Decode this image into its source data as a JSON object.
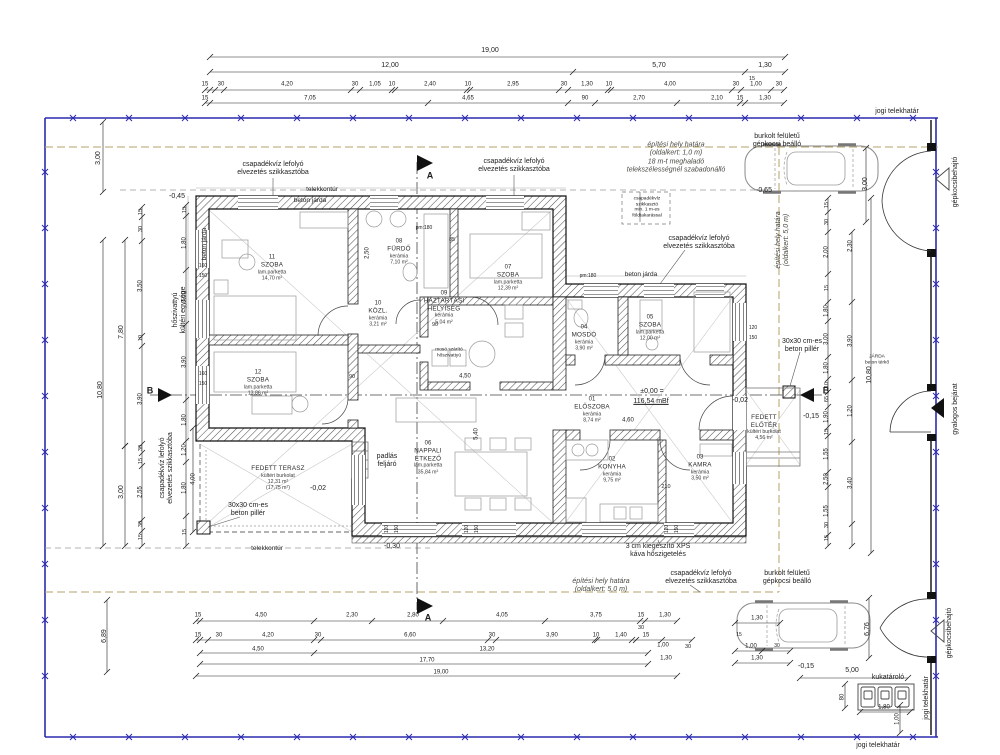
{
  "plan_colors": {
    "boundary_blue": "#2b2bb0",
    "site_limit_khaki": "#b5a368",
    "wall_hatch": "#555555",
    "line_black": "#1d1d1d"
  },
  "rooms": [
    {
      "num": "11",
      "label": "SZOBA",
      "finish": "lam.parketta",
      "area": "14,70 m²",
      "area2": "",
      "x": 272,
      "y": 268
    },
    {
      "num": "12",
      "label": "SZOBA",
      "finish": "lam.parketta",
      "area": "13,86 m²",
      "area2": "",
      "x": 258,
      "y": 383
    },
    {
      "num": "08",
      "label": "FÜRDŐ",
      "finish": "kerámia",
      "area": "7,10 m²",
      "area2": "",
      "x": 399,
      "y": 252
    },
    {
      "num": "10",
      "label": "KÖZL.",
      "finish": "kerámia",
      "area": "3,21 m²",
      "area2": "",
      "x": 378,
      "y": 314
    },
    {
      "num": "09",
      "label": "HÁZTARTÁSI\nHELYISÉG",
      "finish": "kerámia",
      "area": "5,04 m²",
      "area2": "",
      "x": 444,
      "y": 308
    },
    {
      "num": "07",
      "label": "SZOBA",
      "finish": "lam.parketta",
      "area": "12,39 m²",
      "area2": "",
      "x": 508,
      "y": 278
    },
    {
      "num": "04",
      "label": "MOSDÓ",
      "finish": "kerámia",
      "area": "3,90 m²",
      "area2": "",
      "x": 584,
      "y": 338
    },
    {
      "num": "05",
      "label": "SZOBA",
      "finish": "lam.parketta",
      "area": "12,00 m²",
      "area2": "",
      "x": 650,
      "y": 328
    },
    {
      "num": "01",
      "label": "ELŐSZOBA",
      "finish": "kerámia",
      "area": "8,74 m²",
      "area2": "",
      "x": 592,
      "y": 410
    },
    {
      "num": "06",
      "label": "NAPPALI\nÉTKEZŐ",
      "finish": "lam.parketta",
      "area": "35,84 m²",
      "area2": "",
      "x": 428,
      "y": 458
    },
    {
      "num": "02",
      "label": "KONYHA",
      "finish": "kerámia",
      "area": "9,75 m²",
      "area2": "",
      "x": 612,
      "y": 470
    },
    {
      "num": "03",
      "label": "KAMRA",
      "finish": "kerámia",
      "area": "3,50 m²",
      "area2": "",
      "x": 700,
      "y": 468
    },
    {
      "num": "",
      "label": "FEDETT TERASZ",
      "finish": "kültéri burkolat",
      "area": "12,31 m²",
      "area2": "(17,75 m²)",
      "x": 278,
      "y": 478
    },
    {
      "num": "",
      "label": "FEDETT\nELŐTÉR",
      "finish": "kültéri burkolat",
      "area": "4,56 m²",
      "area2": "",
      "x": 764,
      "y": 428
    }
  ],
  "labels": [
    {
      "t": "jogi telekhatár",
      "x": 897,
      "y": 112
    },
    {
      "t": "jogi telekhatár",
      "x": 878,
      "y": 746
    },
    {
      "t": "jogi telekhatár",
      "x": 927,
      "y": 698,
      "r": -90
    },
    {
      "t": "burkolt felületű\ngépkocsi beálló",
      "x": 777,
      "y": 141
    },
    {
      "t": "burkolt felületű\ngépkocsi beálló",
      "x": 787,
      "y": 578
    },
    {
      "t": "gépkocsibehajtó",
      "x": 956,
      "y": 182,
      "r": -90
    },
    {
      "t": "gépkocsibehajtó",
      "x": 950,
      "y": 633,
      "r": -90
    },
    {
      "t": "gyalogos bejárat",
      "x": 956,
      "y": 409,
      "r": -90
    },
    {
      "t": "csapadékvíz lefolyó\nelvezetés szikkasztóba",
      "x": 273,
      "y": 169
    },
    {
      "t": "csapadékvíz lefolyó\nelvezetés szikkasztóba",
      "x": 514,
      "y": 166
    },
    {
      "t": "csapadékvíz lefolyó\nelvezetés szikkasztóba",
      "x": 699,
      "y": 243
    },
    {
      "t": "csapadékvíz lefolyó\nelvezetés szikkasztóba",
      "x": 701,
      "y": 578
    },
    {
      "t": "csapadékvíz lefolyó\nelvezetés szikkasztóba",
      "x": 167,
      "y": 468,
      "r": -90
    },
    {
      "t": "hőszivattyú\nkültéri egysége",
      "x": 180,
      "y": 310,
      "r": -90
    },
    {
      "t": "építési hely határa\n(oldalkert: 1,0 m)\n18 m-t meghaladó\ntelekszélességnél szabadonálló",
      "x": 676,
      "y": 158,
      "c": "i"
    },
    {
      "t": "építési hely határa\n(oldalkert: 5,0 m)",
      "x": 601,
      "y": 586,
      "c": "i"
    },
    {
      "t": "építési hely határa\n(oldalkert: 5,0 m)",
      "x": 783,
      "y": 240,
      "r": -90,
      "c": "i"
    },
    {
      "t": "telekkontúr",
      "x": 322,
      "y": 190,
      "s": 6.5
    },
    {
      "t": "telekkontúr",
      "x": 267,
      "y": 549,
      "s": 6.5
    },
    {
      "t": "beton járda",
      "x": 310,
      "y": 201,
      "s": 6.5
    },
    {
      "t": "beton járda",
      "x": 205,
      "y": 244,
      "r": -90,
      "s": 6.5
    },
    {
      "t": "beton járda",
      "x": 641,
      "y": 275,
      "s": 6.5
    },
    {
      "t": "30x30 cm-es\nbeton pillér",
      "x": 248,
      "y": 510
    },
    {
      "t": "30x30 cm-es\nbeton pillér",
      "x": 802,
      "y": 346
    },
    {
      "t": "padlás\nfeljáró",
      "x": 387,
      "y": 461
    },
    {
      "t": "3 cm kiegészítő XPS\nkáva hőszigetelés",
      "x": 658,
      "y": 551
    },
    {
      "t": "kukatároló",
      "x": 888,
      "y": 678
    },
    {
      "t": "csapadékvíz\nszikkasztó\nmin. 1 m-es\nföldtakarással",
      "x": 647,
      "y": 208,
      "s": 4.8
    },
    {
      "t": "JÁRDA\nbeton térkő",
      "x": 877,
      "y": 360,
      "s": 4.8
    },
    {
      "t": "mosó szárító\nhőszivattyú",
      "x": 449,
      "y": 353,
      "s": 4.8
    },
    {
      "t": "A",
      "x": 430,
      "y": 176,
      "c": "b"
    },
    {
      "t": "A",
      "x": 428,
      "y": 618,
      "c": "b"
    },
    {
      "t": "B",
      "x": 150,
      "y": 391,
      "c": "b"
    },
    {
      "t": "B",
      "x": 826,
      "y": 391,
      "c": "b"
    },
    {
      "t": "pm:180",
      "x": 424,
      "y": 229,
      "s": 5
    },
    {
      "t": "pm:180",
      "x": 588,
      "y": 277,
      "s": 5
    },
    {
      "t": "-0,45",
      "x": 177,
      "y": 197
    },
    {
      "t": "-0,65",
      "x": 764,
      "y": 191
    },
    {
      "t": "-0,02",
      "x": 318,
      "y": 489
    },
    {
      "t": "-0,02",
      "x": 740,
      "y": 401
    },
    {
      "t": "-0,30",
      "x": 392,
      "y": 547
    },
    {
      "t": "-0,15",
      "x": 811,
      "y": 417
    },
    {
      "t": "-0,15",
      "x": 806,
      "y": 667
    },
    {
      "t": "±0,00 =",
      "x": 652,
      "y": 392
    },
    {
      "t": "116,54 mBf",
      "x": 651,
      "y": 402,
      "c": "u"
    },
    {
      "t": "19,00",
      "x": 490,
      "y": 51
    },
    {
      "t": "12,00",
      "x": 390,
      "y": 66
    },
    {
      "t": "5,70",
      "x": 659,
      "y": 66
    },
    {
      "t": "1,30",
      "x": 765,
      "y": 66
    },
    {
      "t": "15",
      "x": 752,
      "y": 79,
      "s": 5.5
    },
    {
      "t": "15",
      "x": 205,
      "y": 85,
      "s": 6
    },
    {
      "t": "30",
      "x": 221,
      "y": 85,
      "s": 6
    },
    {
      "t": "4,20",
      "x": 287,
      "y": 85,
      "s": 6
    },
    {
      "t": "30",
      "x": 355,
      "y": 85,
      "s": 6
    },
    {
      "t": "1,05",
      "x": 375,
      "y": 85,
      "s": 6
    },
    {
      "t": "10",
      "x": 392,
      "y": 85,
      "s": 6
    },
    {
      "t": "2,40",
      "x": 430,
      "y": 85,
      "s": 6
    },
    {
      "t": "10",
      "x": 468,
      "y": 85,
      "s": 6
    },
    {
      "t": "2,95",
      "x": 513,
      "y": 85,
      "s": 6
    },
    {
      "t": "30",
      "x": 564,
      "y": 85,
      "s": 6
    },
    {
      "t": "1,30",
      "x": 587,
      "y": 85,
      "s": 6
    },
    {
      "t": "10",
      "x": 609,
      "y": 85,
      "s": 6
    },
    {
      "t": "4,00",
      "x": 670,
      "y": 85,
      "s": 6
    },
    {
      "t": "30",
      "x": 736,
      "y": 85,
      "s": 6
    },
    {
      "t": "1,00",
      "x": 756,
      "y": 85,
      "s": 6
    },
    {
      "t": "30",
      "x": 779,
      "y": 85,
      "s": 6
    },
    {
      "t": "15",
      "x": 205,
      "y": 99,
      "s": 6
    },
    {
      "t": "7,05",
      "x": 310,
      "y": 99,
      "s": 6
    },
    {
      "t": "4,65",
      "x": 468,
      "y": 99,
      "s": 6
    },
    {
      "t": "90",
      "x": 585,
      "y": 99,
      "s": 6
    },
    {
      "t": "2,70",
      "x": 639,
      "y": 99,
      "s": 6
    },
    {
      "t": "2,10",
      "x": 717,
      "y": 99,
      "s": 6
    },
    {
      "t": "15",
      "x": 740,
      "y": 99,
      "s": 6
    },
    {
      "t": "1,30",
      "x": 765,
      "y": 99,
      "s": 6
    },
    {
      "t": "15",
      "x": 198,
      "y": 616,
      "s": 6
    },
    {
      "t": "4,50",
      "x": 261,
      "y": 616,
      "s": 6
    },
    {
      "t": "2,30",
      "x": 352,
      "y": 616,
      "s": 6
    },
    {
      "t": "2,80",
      "x": 413,
      "y": 616,
      "s": 6
    },
    {
      "t": "4,05",
      "x": 502,
      "y": 616,
      "s": 6
    },
    {
      "t": "3,75",
      "x": 596,
      "y": 616,
      "s": 6
    },
    {
      "t": "15",
      "x": 641,
      "y": 616,
      "s": 6
    },
    {
      "t": "1,30",
      "x": 665,
      "y": 616,
      "s": 6
    },
    {
      "t": "30",
      "x": 641,
      "y": 628,
      "s": 5.5
    },
    {
      "t": "15",
      "x": 198,
      "y": 636,
      "s": 6
    },
    {
      "t": "30",
      "x": 219,
      "y": 636,
      "s": 6
    },
    {
      "t": "4,20",
      "x": 268,
      "y": 636,
      "s": 6
    },
    {
      "t": "30",
      "x": 318,
      "y": 636,
      "s": 6
    },
    {
      "t": "6,60",
      "x": 410,
      "y": 636,
      "s": 6
    },
    {
      "t": "30",
      "x": 492,
      "y": 636,
      "s": 6
    },
    {
      "t": "3,90",
      "x": 552,
      "y": 636,
      "s": 6
    },
    {
      "t": "10",
      "x": 596,
      "y": 636,
      "s": 6
    },
    {
      "t": "1,40",
      "x": 621,
      "y": 636,
      "s": 6
    },
    {
      "t": "15",
      "x": 646,
      "y": 636,
      "s": 6
    },
    {
      "t": "1,00",
      "x": 663,
      "y": 646,
      "s": 6
    },
    {
      "t": "30",
      "x": 688,
      "y": 647,
      "s": 5.5
    },
    {
      "t": "4,50",
      "x": 258,
      "y": 650,
      "s": 6
    },
    {
      "t": "13,20",
      "x": 487,
      "y": 650,
      "s": 6
    },
    {
      "t": "1,30",
      "x": 666,
      "y": 659,
      "s": 6
    },
    {
      "t": "17,70",
      "x": 427,
      "y": 661,
      "s": 6
    },
    {
      "t": "19,00",
      "x": 441,
      "y": 673,
      "s": 6
    },
    {
      "t": "3,00",
      "x": 99,
      "y": 158,
      "r": -90
    },
    {
      "t": "10,80",
      "x": 101,
      "y": 390,
      "r": -90
    },
    {
      "t": "6,89",
      "x": 105,
      "y": 636,
      "r": -90
    },
    {
      "t": "7,80",
      "x": 122,
      "y": 332,
      "r": -90
    },
    {
      "t": "3,00",
      "x": 122,
      "y": 492,
      "r": -90
    },
    {
      "t": "15",
      "x": 141,
      "y": 212,
      "r": -90,
      "s": 5.5
    },
    {
      "t": "30",
      "x": 141,
      "y": 229,
      "r": -90,
      "s": 5.5
    },
    {
      "t": "3,50",
      "x": 141,
      "y": 286,
      "r": -90,
      "s": 6
    },
    {
      "t": "10",
      "x": 141,
      "y": 338,
      "r": -90,
      "s": 5.5
    },
    {
      "t": "3,90",
      "x": 141,
      "y": 399,
      "r": -90,
      "s": 6
    },
    {
      "t": "30",
      "x": 141,
      "y": 448,
      "r": -90,
      "s": 5.5
    },
    {
      "t": "15",
      "x": 141,
      "y": 461,
      "r": -90,
      "s": 5.5
    },
    {
      "t": "2,55",
      "x": 141,
      "y": 492,
      "r": -90,
      "s": 6
    },
    {
      "t": "30",
      "x": 141,
      "y": 524,
      "r": -90,
      "s": 5.5
    },
    {
      "t": "15",
      "x": 141,
      "y": 537,
      "r": -90,
      "s": 5.5
    },
    {
      "t": "15",
      "x": 185,
      "y": 210,
      "r": -90,
      "s": 5.5
    },
    {
      "t": "1,80",
      "x": 185,
      "y": 243,
      "r": -90,
      "s": 6
    },
    {
      "t": "3,50",
      "x": 185,
      "y": 297,
      "r": -90,
      "s": 6
    },
    {
      "t": "3,90",
      "x": 185,
      "y": 362,
      "r": -90,
      "s": 6
    },
    {
      "t": "1,80",
      "x": 185,
      "y": 420,
      "r": -90,
      "s": 6
    },
    {
      "t": "1,20",
      "x": 185,
      "y": 450,
      "r": -90,
      "s": 6
    },
    {
      "t": "1,80",
      "x": 185,
      "y": 488,
      "r": -90,
      "s": 6
    },
    {
      "t": "15",
      "x": 185,
      "y": 532,
      "r": -90,
      "s": 5.5
    },
    {
      "t": "4,00",
      "x": 194,
      "y": 479,
      "r": -90,
      "s": 6
    },
    {
      "t": "160",
      "x": 203,
      "y": 267,
      "s": 5
    },
    {
      "t": "150",
      "x": 203,
      "y": 277,
      "s": 5
    },
    {
      "t": "160",
      "x": 203,
      "y": 375,
      "s": 5
    },
    {
      "t": "150",
      "x": 203,
      "y": 385,
      "s": 5
    },
    {
      "t": "120",
      "x": 753,
      "y": 329,
      "s": 5
    },
    {
      "t": "150",
      "x": 753,
      "y": 339,
      "s": 5
    },
    {
      "t": "15",
      "x": 827,
      "y": 205,
      "r": -90,
      "s": 5.5
    },
    {
      "t": "30",
      "x": 827,
      "y": 222,
      "r": -90,
      "s": 5.5
    },
    {
      "t": "2,00",
      "x": 827,
      "y": 252,
      "r": -90,
      "s": 6
    },
    {
      "t": "15",
      "x": 827,
      "y": 288,
      "r": -90,
      "s": 5.5
    },
    {
      "t": "1,80",
      "x": 827,
      "y": 311,
      "r": -90,
      "s": 6
    },
    {
      "t": "3,00",
      "x": 827,
      "y": 339,
      "r": -90,
      "s": 6
    },
    {
      "t": "1,80",
      "x": 827,
      "y": 368,
      "r": -90,
      "s": 6
    },
    {
      "t": "10",
      "x": 827,
      "y": 385,
      "r": -90,
      "s": 5.5
    },
    {
      "t": "65",
      "x": 827,
      "y": 399,
      "r": -90,
      "s": 5.5
    },
    {
      "t": "1,90",
      "x": 827,
      "y": 417,
      "r": -90,
      "s": 6
    },
    {
      "t": "15",
      "x": 827,
      "y": 432,
      "r": -90,
      "s": 5.5
    },
    {
      "t": "1,55",
      "x": 827,
      "y": 454,
      "r": -90,
      "s": 6
    },
    {
      "t": "2,50",
      "x": 827,
      "y": 479,
      "r": -90,
      "s": 6
    },
    {
      "t": "1,55",
      "x": 827,
      "y": 511,
      "r": -90,
      "s": 6
    },
    {
      "t": "30",
      "x": 827,
      "y": 525,
      "r": -90,
      "s": 5.5
    },
    {
      "t": "15",
      "x": 827,
      "y": 538,
      "r": -90,
      "s": 5.5
    },
    {
      "t": "2,30",
      "x": 851,
      "y": 246,
      "r": -90,
      "s": 6
    },
    {
      "t": "3,90",
      "x": 851,
      "y": 341,
      "r": -90,
      "s": 6
    },
    {
      "t": "1,20",
      "x": 851,
      "y": 411,
      "r": -90,
      "s": 6
    },
    {
      "t": "3,40",
      "x": 851,
      "y": 483,
      "r": -90,
      "s": 6
    },
    {
      "t": "10,80",
      "x": 870,
      "y": 375,
      "r": -90
    },
    {
      "t": "3,00",
      "x": 866,
      "y": 184,
      "r": -90
    },
    {
      "t": "6,76",
      "x": 868,
      "y": 629,
      "r": -90
    },
    {
      "t": "80",
      "x": 843,
      "y": 697,
      "r": -90,
      "s": 6
    },
    {
      "t": "1,00",
      "x": 898,
      "y": 719,
      "r": -90,
      "s": 6
    },
    {
      "t": "5,00",
      "x": 852,
      "y": 671
    },
    {
      "t": "1,80",
      "x": 884,
      "y": 708,
      "s": 6
    },
    {
      "t": "1,30",
      "x": 757,
      "y": 619,
      "s": 6
    },
    {
      "t": "15",
      "x": 739,
      "y": 636,
      "s": 5
    },
    {
      "t": "1,00",
      "x": 751,
      "y": 647,
      "s": 6
    },
    {
      "t": "30",
      "x": 777,
      "y": 647,
      "s": 5
    },
    {
      "t": "1,30",
      "x": 757,
      "y": 659,
      "s": 6
    },
    {
      "t": "85",
      "x": 452,
      "y": 240,
      "s": 5.5
    },
    {
      "t": "4,50",
      "x": 465,
      "y": 377,
      "s": 6
    },
    {
      "t": "90",
      "x": 352,
      "y": 377,
      "s": 5.5
    },
    {
      "t": "90",
      "x": 435,
      "y": 325,
      "s": 5.5
    },
    {
      "t": "4,60",
      "x": 628,
      "y": 421,
      "s": 6
    },
    {
      "t": "210",
      "x": 666,
      "y": 487,
      "s": 5.5
    },
    {
      "t": "2,50",
      "x": 368,
      "y": 253,
      "r": -90,
      "s": 6
    },
    {
      "t": "5,40",
      "x": 477,
      "y": 434,
      "r": -90,
      "s": 6
    },
    {
      "t": "120",
      "x": 388,
      "y": 529,
      "r": -90,
      "s": 5
    },
    {
      "t": "150",
      "x": 398,
      "y": 529,
      "r": -90,
      "s": 5
    },
    {
      "t": "120",
      "x": 468,
      "y": 529,
      "r": -90,
      "s": 5
    },
    {
      "t": "150",
      "x": 478,
      "y": 529,
      "r": -90,
      "s": 5
    },
    {
      "t": "120",
      "x": 668,
      "y": 529,
      "r": -90,
      "s": 5
    },
    {
      "t": "150",
      "x": 678,
      "y": 529,
      "r": -90,
      "s": 5
    }
  ]
}
